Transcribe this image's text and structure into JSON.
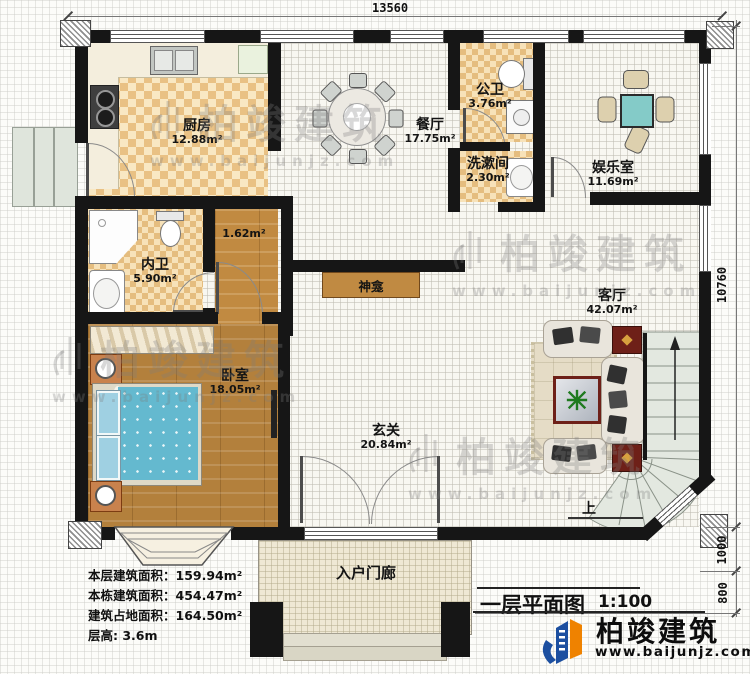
{
  "dimensions": {
    "top_width": "13560",
    "right_height": "10760",
    "right_mid": "1000",
    "right_bottom": "800"
  },
  "rooms": {
    "kitchen": {
      "name": "厨房",
      "area": "12.88m²"
    },
    "dining": {
      "name": "餐厅",
      "area": "17.75m²"
    },
    "public_wc": {
      "name": "公卫",
      "area": "3.76m²"
    },
    "washroom": {
      "name": "洗漱间",
      "area": "2.30m²"
    },
    "entertainment": {
      "name": "娱乐室",
      "area": "11.69m²"
    },
    "private_wc": {
      "name": "内卫",
      "area": "5.90m²"
    },
    "bedroom": {
      "name": "卧室",
      "area": "18.05m²"
    },
    "foyer": {
      "name": "玄关",
      "area": "20.84m²"
    },
    "living": {
      "name": "客厅",
      "area": "42.07m²"
    },
    "porch": {
      "name": "入户门廊"
    },
    "shrine": {
      "name": "神龛"
    }
  },
  "corridor_area": "1.62m²",
  "stairs_up": "上",
  "stats": {
    "floor_area": "本层建筑面积：159.94m²",
    "building_area": "本栋建筑面积：454.47m²",
    "footprint_area": "建筑占地面积：164.50m²",
    "floor_height": "层高: 3.6m"
  },
  "titleblock": {
    "title": "一层平面图",
    "scale": "1:100"
  },
  "brand": {
    "name": "柏竣建筑",
    "site": "www.baijunjz.com"
  },
  "watermark": {
    "name": "柏竣建筑",
    "site": "www.baijunjz.com"
  }
}
